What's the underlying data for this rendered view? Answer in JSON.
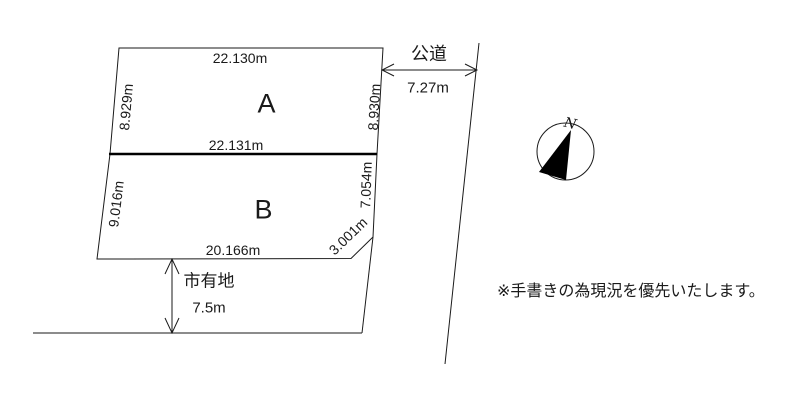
{
  "diagram": {
    "plot_a": {
      "label": "A",
      "dim_top": "22.130m",
      "dim_left": "8.929m",
      "dim_right": "8.930m",
      "dim_bottom": "22.131m"
    },
    "plot_b": {
      "label": "B",
      "dim_left": "9.016m",
      "dim_right": "7.054m",
      "dim_diagonal": "3.001m",
      "dim_bottom": "20.166m"
    },
    "road": {
      "label": "公道",
      "width": "7.27m"
    },
    "city_land": {
      "label": "市有地",
      "width": "7.5m"
    },
    "compass": {
      "north_label": "N"
    },
    "note": "※手書きの為現況を優先いたします。"
  },
  "colors": {
    "line": "#1a1a1a",
    "background": "#ffffff"
  }
}
